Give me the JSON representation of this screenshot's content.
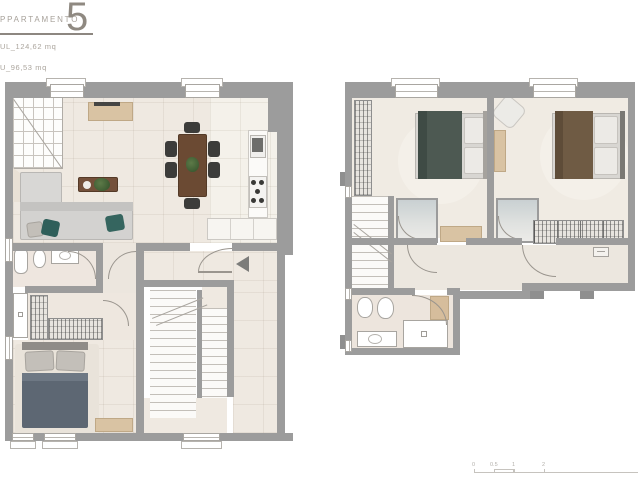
{
  "header": {
    "title": "PPARTAMENTO",
    "number": "5",
    "area_line1": "UL_124,62 mq",
    "area_line2": "U_96,53 mq"
  },
  "scale_bar": {
    "labels": [
      "0",
      "0.5",
      "1",
      "2"
    ]
  },
  "colors": {
    "wall": "#9c9c9c",
    "floor": "#efe9e1",
    "floor_light": "#f4f1ea",
    "wood": "#d9c3a3",
    "dark_wood": "#6b4a33",
    "accent_teal": "#2f5f5a",
    "bed_slate": "#5d6773",
    "blanket_green": "#4d5952",
    "blanket_brown": "#6f5b44",
    "shower": "#c9d0d2",
    "text": "#a7a19a"
  }
}
